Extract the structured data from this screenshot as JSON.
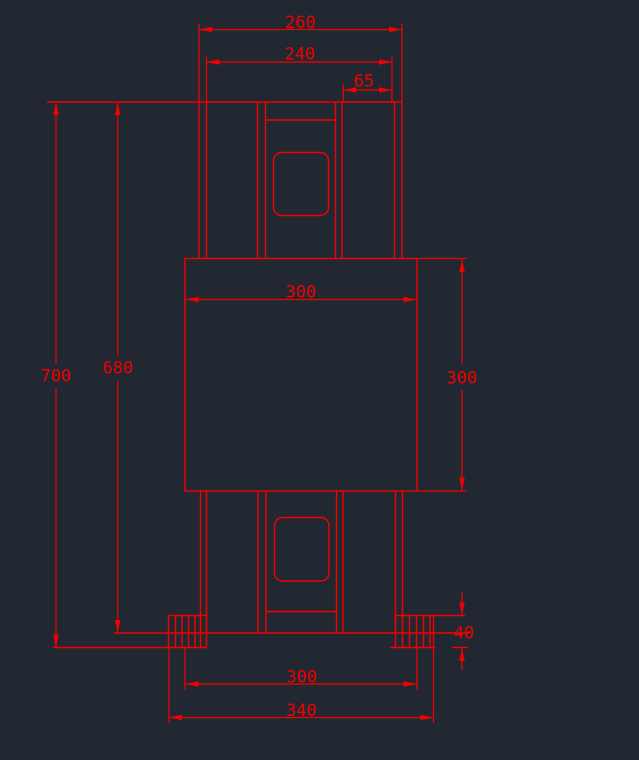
{
  "colors": {
    "canvas-bg": "#212831",
    "line": "#f40000"
  },
  "dimensions": {
    "top_outer_width": "260",
    "top_inner_width": "240",
    "top_right_offset": "65",
    "body_width": "300",
    "body_height": "300",
    "overall_height": "700",
    "height_to_base": "680",
    "base_pad_height": "40",
    "base_inner_width": "300",
    "base_outer_width": "340"
  }
}
